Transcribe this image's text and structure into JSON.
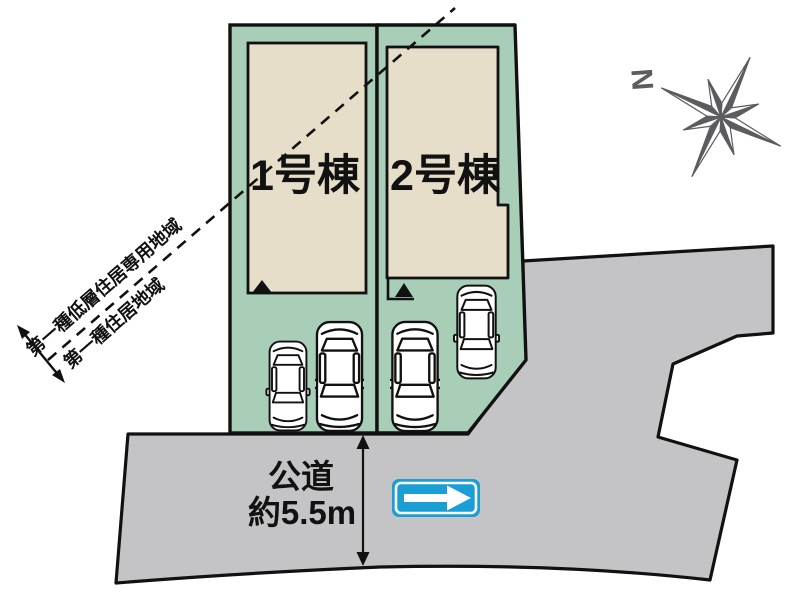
{
  "plots": [
    {
      "label": "1号棟"
    },
    {
      "label": "2号棟"
    }
  ],
  "zoning": {
    "primary": "第一種低層住居専用地域",
    "secondary": "第一種住居地域"
  },
  "road": {
    "label": "公道",
    "width_label": "約5.5m"
  },
  "compass": {
    "north": "N"
  },
  "colors": {
    "plot_green": "#a8ceb8",
    "building_beige": "#e6dec8",
    "road_gray": "#c4c4c6",
    "sign_blue": "#1a9ed6",
    "compass_gray": "#5c5c60"
  }
}
